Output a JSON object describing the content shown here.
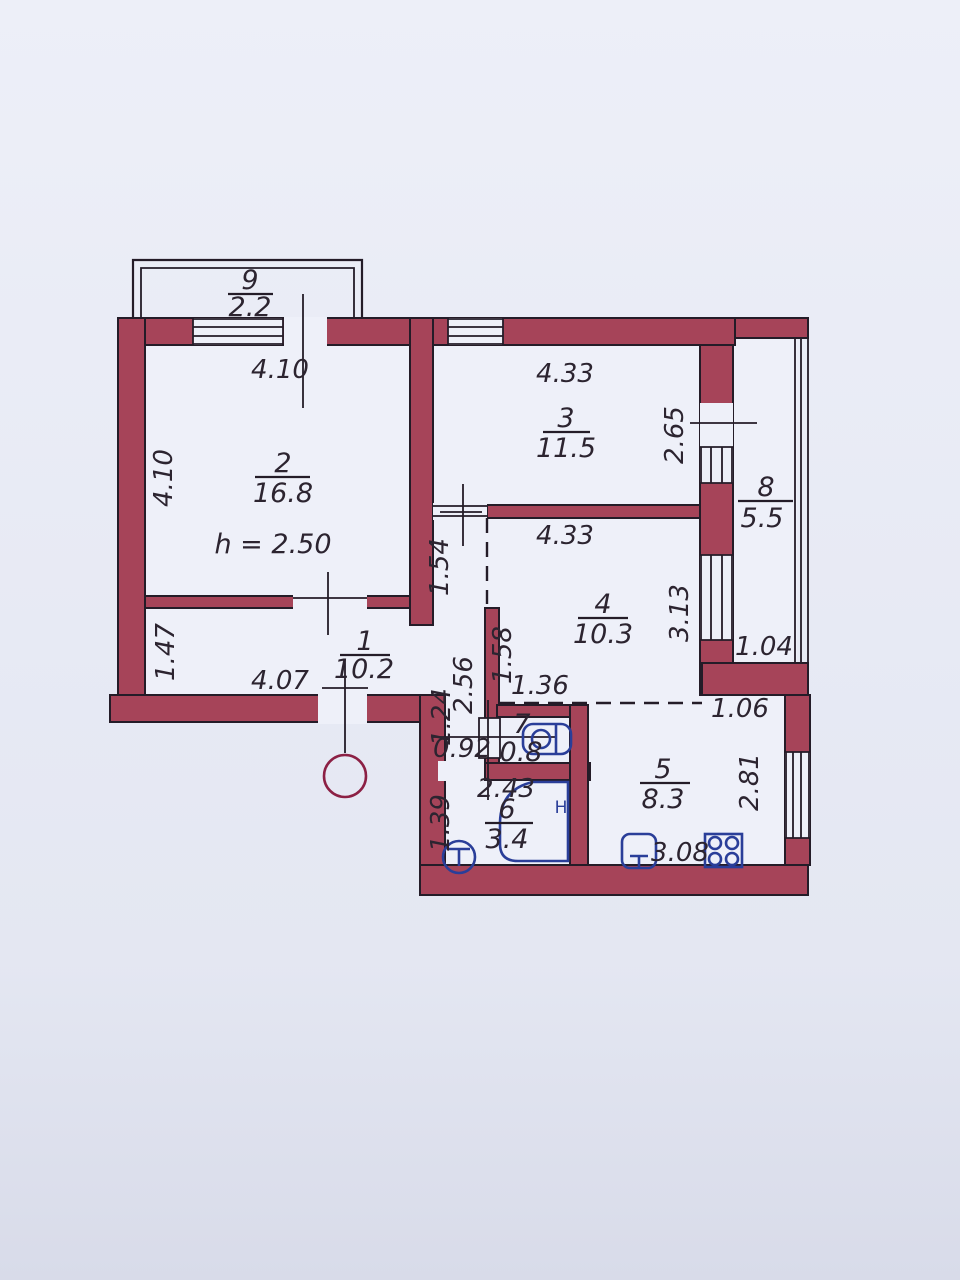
{
  "plan": {
    "ceiling_height_note": "h = 2.50",
    "rooms": {
      "r1": {
        "num": "1",
        "area": "10.2"
      },
      "r2": {
        "num": "2",
        "area": "16.8"
      },
      "r3": {
        "num": "3",
        "area": "11.5"
      },
      "r4": {
        "num": "4",
        "area": "10.3"
      },
      "r5": {
        "num": "5",
        "area": "8.3"
      },
      "r6": {
        "num": "6",
        "area": "3.4"
      },
      "r7": {
        "num": "7",
        "area": "0.8"
      },
      "r8": {
        "num": "8",
        "area": "5.5"
      },
      "r9": {
        "num": "9",
        "area": "2.2"
      }
    },
    "dims": {
      "top_width": "4.10",
      "left_height": "4.10",
      "room3_width": "4.33",
      "room3_right": "2.65",
      "room4_width": "4.33",
      "room4_right": "3.13",
      "balcony8_width": "1.04",
      "hall_left": "1.47",
      "hall_bottom": "4.07",
      "pass_154": "1.54",
      "pass_158": "1.58",
      "pass_136": "1.36",
      "corridor_256": "2.56",
      "corridor_124": "1.24",
      "corridor_092": "0.92",
      "bath_width": "2.43",
      "bath_left": "1.39",
      "kitchen_notch": "1.06",
      "kitchen_right": "2.81",
      "kitchen_bottom": "3.08",
      "hot_tap_mark": "H"
    },
    "colors": {
      "wall": "#a64459",
      "floor": "#eef0f9",
      "paper_top": "#ebedf7",
      "paper_bottom": "#dcdfec",
      "line": "#241c28",
      "text": "#2c2430",
      "fixture": "#2a3e99",
      "door": "#8c2044"
    }
  }
}
